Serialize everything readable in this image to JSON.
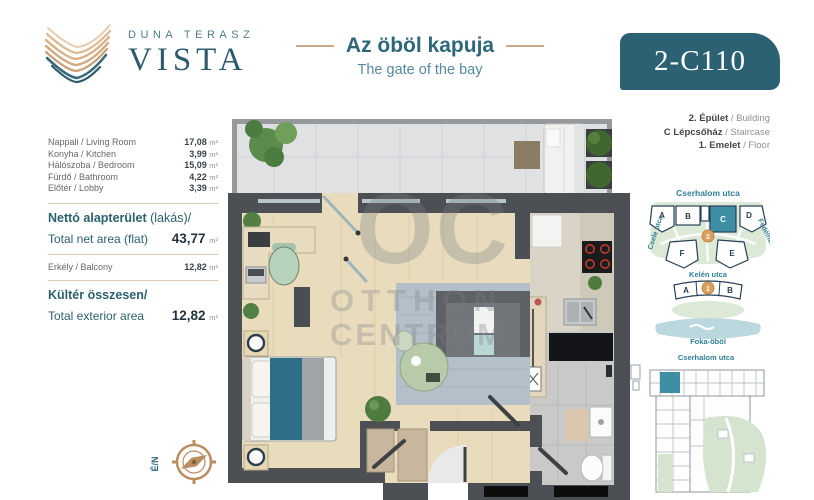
{
  "header": {
    "brand_top": "DUNA TERASZ",
    "brand_name": "VISTA",
    "title_hu": "Az öböl kapuja",
    "title_en": "The gate of the bay",
    "unit_code": "2-C110"
  },
  "areas": {
    "unit": "m²",
    "rooms": [
      {
        "label": "Nappali / Living Room",
        "value": "17,08"
      },
      {
        "label": "Konyha / Kitchen",
        "value": "3,99"
      },
      {
        "label": "Hálószoba / Bedroom",
        "value": "15,09"
      },
      {
        "label": "Fürdő / Bathroom",
        "value": "4,22"
      },
      {
        "label": "Előtér / Lobby",
        "value": "3,39"
      }
    ],
    "net_title_bold": "Nettó alapterület",
    "net_title_rest": " (lakás)/",
    "net_label_en": "Total net area (flat)",
    "net_value": "43,77",
    "balcony_label": "Erkély / Balcony",
    "balcony_value": "12,82",
    "exterior_title": "Kültér összesen/",
    "exterior_label_en": "Total exterior area",
    "exterior_value": "12,82"
  },
  "location_info": {
    "building_hu": "2. Épület",
    "building_en": " / Building",
    "staircase_hu": "C Lépcsőház",
    "staircase_en": " / Staircase",
    "floor_hu": "1. Emelet",
    "floor_en": " / Floor"
  },
  "site_map": {
    "street_top": "Cserhalom utca",
    "street_left": "Csele utca",
    "street_right": "Fedélház utca",
    "street_middle": "Kelén utca",
    "bay_label": "Foka-öböl",
    "building_a": "A",
    "building_b": "B",
    "building_c": "C",
    "building_d": "D",
    "building_e": "E",
    "building_f": "F",
    "lower_a": "A",
    "lower_b": "B",
    "phase_2": "2",
    "phase_1": "1"
  },
  "mini_plan": {
    "street_top": "Cserhalom utca"
  },
  "compass": {
    "label": "É/N"
  },
  "watermark": {
    "line1": "OC",
    "line2": "OTTHON",
    "line3": "CENTRUM"
  },
  "colors": {
    "accent_teal": "#2c6173",
    "heading_teal": "#2c6170",
    "tan": "#c9a888",
    "map_teal": "#2f7f99",
    "highlight_unit": "#3e8fa3",
    "phase_circle": "#d9a05f"
  }
}
